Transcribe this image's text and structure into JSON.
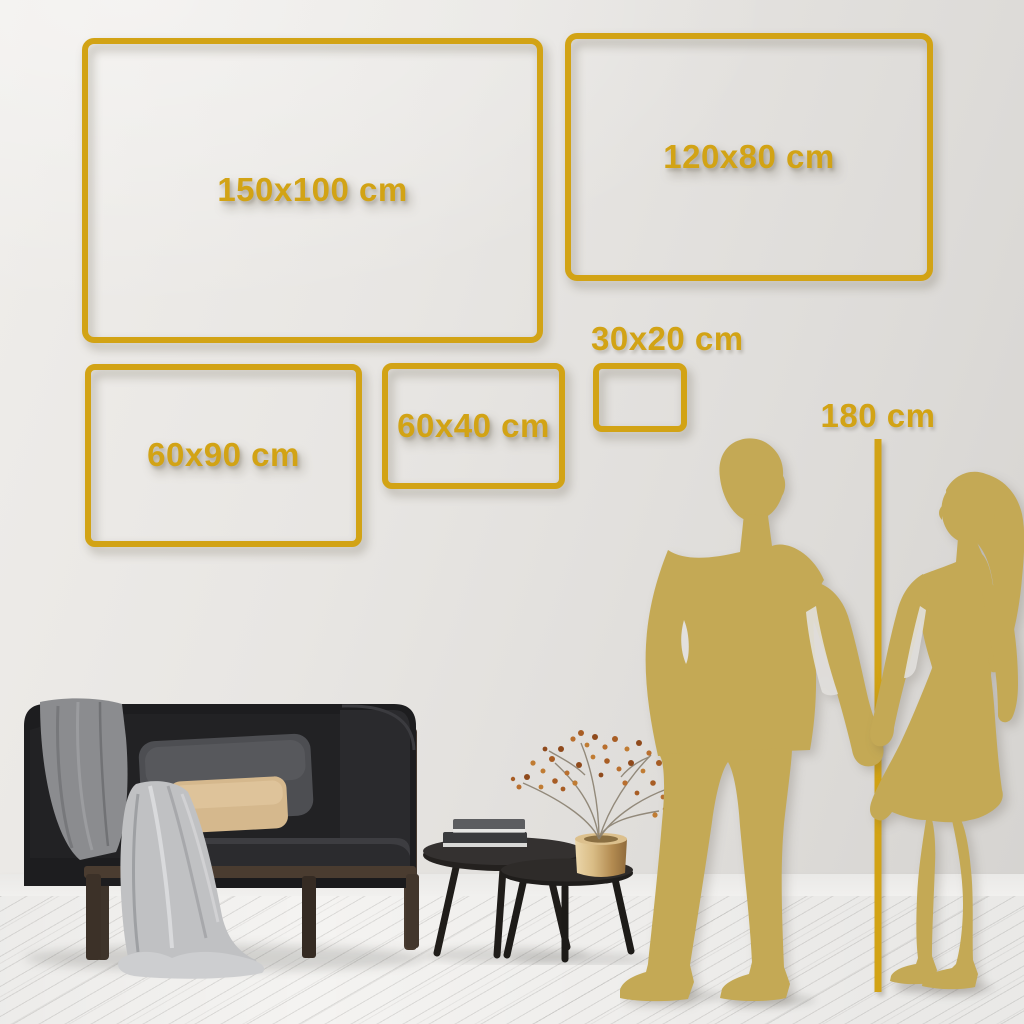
{
  "frames": [
    {
      "name": "frame-150x100",
      "label": "150x100 cm"
    },
    {
      "name": "frame-120x80",
      "label": "120x80 cm"
    },
    {
      "name": "frame-60x90",
      "label": "60x90 cm"
    },
    {
      "name": "frame-60x40",
      "label": "60x40 cm"
    },
    {
      "name": "frame-30x20",
      "label": "30x20 cm"
    }
  ],
  "height_marker": {
    "label": "180 cm"
  },
  "colors": {
    "accent_gold": "#D2A315",
    "silhouette_gold": "#C4A955",
    "wall": "#E4E2DF",
    "floor": "#F4F3F1"
  }
}
